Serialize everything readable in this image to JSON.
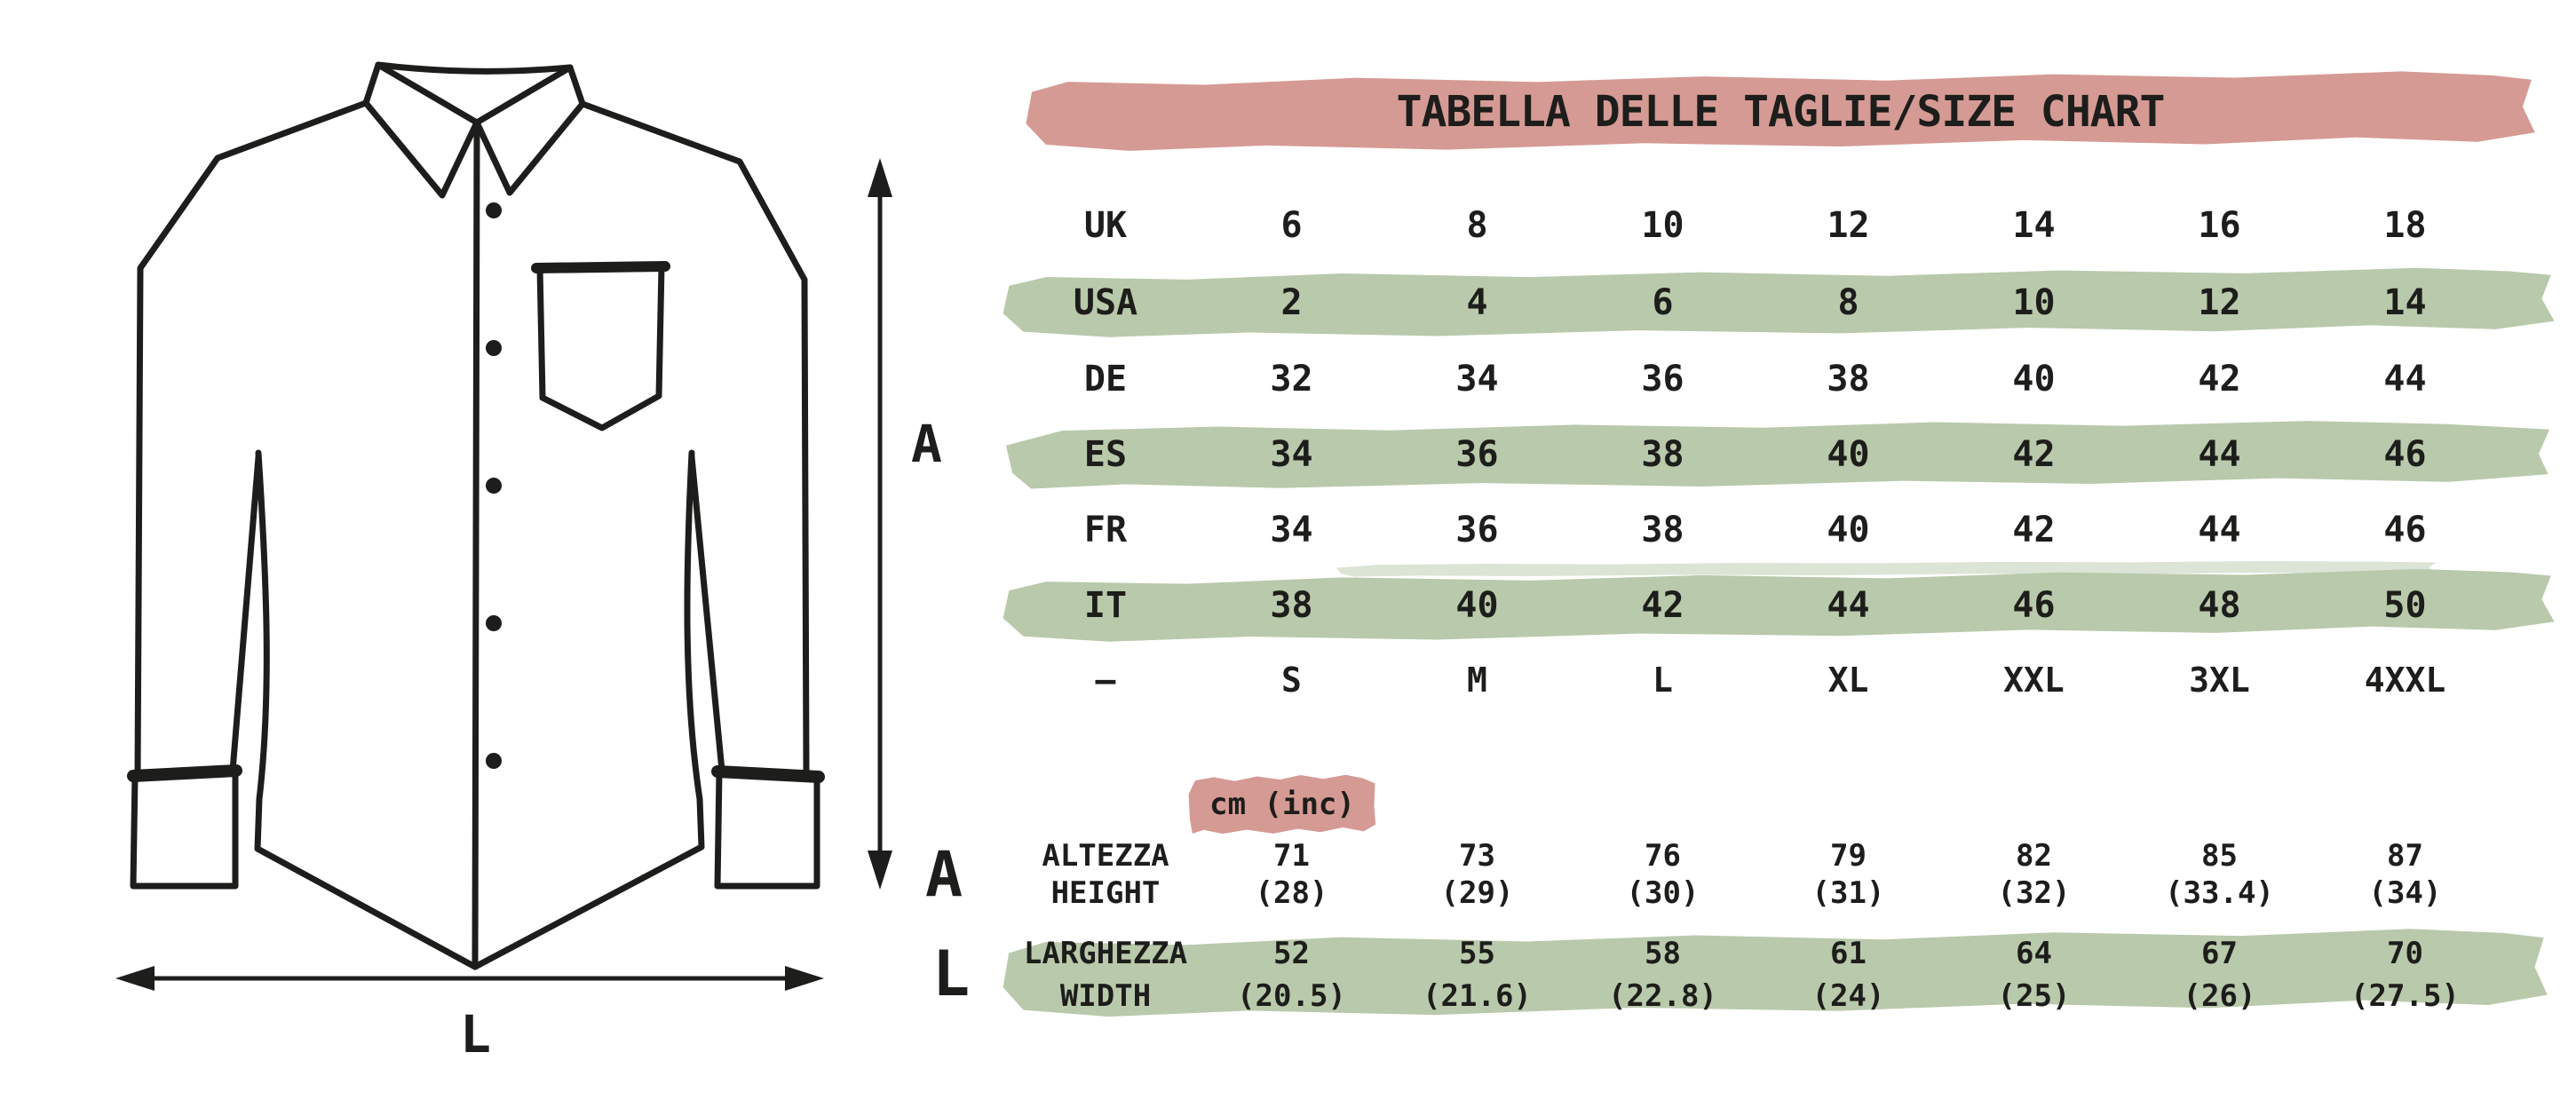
{
  "title": "TABELLA DELLE TAGLIE/SIZE CHART",
  "colors": {
    "pink": "#d59a94",
    "green": "#b9c9ab",
    "ink": "#1d1d1b"
  },
  "diagram": {
    "height_label": "A",
    "width_label": "L"
  },
  "size_table": {
    "rows": [
      {
        "label": "UK",
        "highlight": false,
        "values": [
          "6",
          "8",
          "10",
          "12",
          "14",
          "16",
          "18"
        ]
      },
      {
        "label": "USA",
        "highlight": true,
        "values": [
          "2",
          "4",
          "6",
          "8",
          "10",
          "12",
          "14"
        ]
      },
      {
        "label": "DE",
        "highlight": false,
        "values": [
          "32",
          "34",
          "36",
          "38",
          "40",
          "42",
          "44"
        ]
      },
      {
        "label": "ES",
        "highlight": true,
        "values": [
          "34",
          "36",
          "38",
          "40",
          "42",
          "44",
          "46"
        ]
      },
      {
        "label": "FR",
        "highlight": false,
        "values": [
          "34",
          "36",
          "38",
          "40",
          "42",
          "44",
          "46"
        ]
      },
      {
        "label": "IT",
        "highlight": true,
        "values": [
          "38",
          "40",
          "42",
          "44",
          "46",
          "48",
          "50"
        ]
      },
      {
        "label": "–",
        "highlight": false,
        "values": [
          "S",
          "M",
          "L",
          "XL",
          "XXL",
          "3XL",
          "4XXL"
        ]
      }
    ]
  },
  "measurements": {
    "unit_label": "cm (inc)",
    "rows": [
      {
        "letter": "A",
        "label_line1": "ALTEZZA",
        "label_line2": "HEIGHT",
        "cm": [
          "71",
          "73",
          "76",
          "79",
          "82",
          "85",
          "87"
        ],
        "inches": [
          "(28)",
          "(29)",
          "(30)",
          "(31)",
          "(32)",
          "(33.4)",
          "(34)"
        ],
        "highlight": false
      },
      {
        "letter": "L",
        "label_line1": "LARGHEZZA",
        "label_line2": "WIDTH",
        "cm": [
          "52",
          "55",
          "58",
          "61",
          "64",
          "67",
          "70"
        ],
        "inches": [
          "(20.5)",
          "(21.6)",
          "(22.8)",
          "(24)",
          "(25)",
          "(26)",
          "(27.5)"
        ],
        "highlight": true
      }
    ]
  }
}
